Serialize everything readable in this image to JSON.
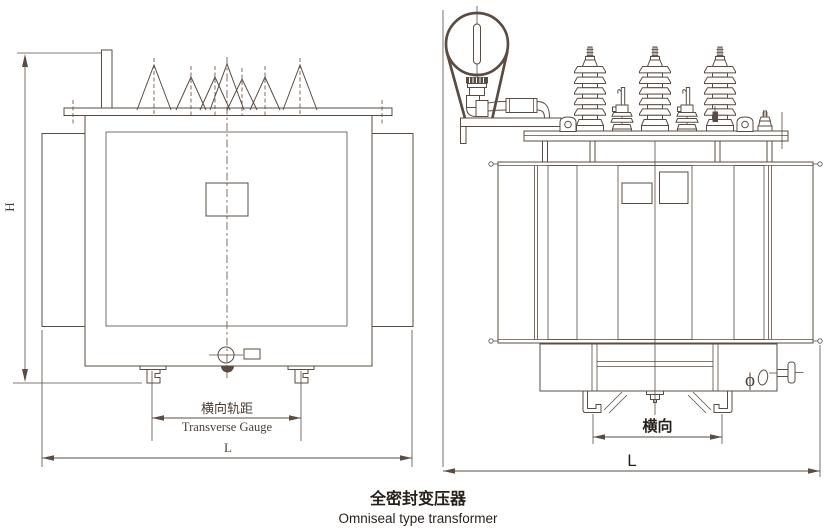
{
  "colors": {
    "line": "#5a4c42",
    "label": "#4a3e34",
    "caption": "#261f1a"
  },
  "front_view": {
    "height_dim_label": "H",
    "length_dim_label": "L",
    "gauge_label_zh": "横向轨距",
    "gauge_label_en": "Transverse Gauge"
  },
  "side_view": {
    "length_dim_label": "L",
    "gauge_label_zh": "横向",
    "valve_symbol": "ϕ"
  },
  "caption": {
    "title_zh": "全密封变压器",
    "title_en": "Omniseal type transformer"
  }
}
